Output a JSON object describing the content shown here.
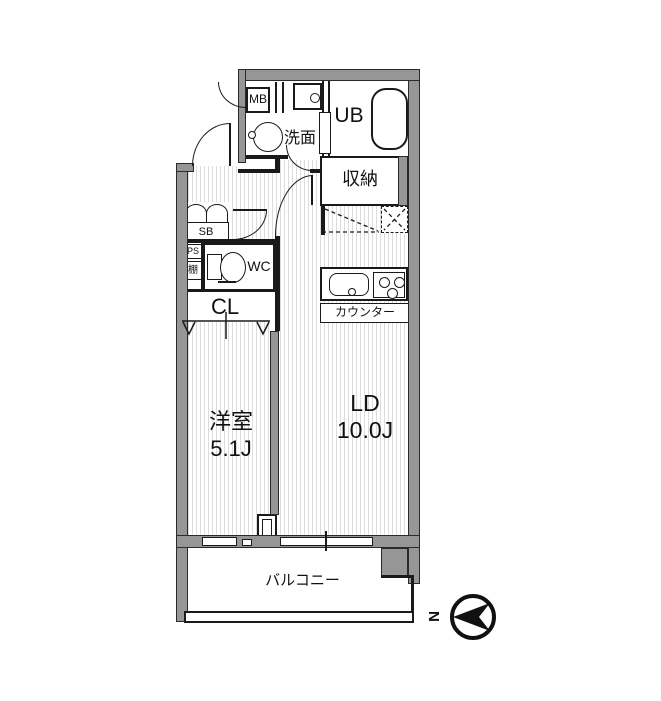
{
  "plan": {
    "rooms": {
      "mb": "MB",
      "washroom": "洗面",
      "unit_bath": "UB",
      "storage": "収納",
      "shoe_box": "SB",
      "pipe_space": "PS",
      "shelf": "棚",
      "toilet": "WC",
      "closet": "CL",
      "western_room_name": "洋室",
      "western_room_size": "5.1J",
      "living_dining_name": "LD",
      "living_dining_size": "10.0J",
      "kitchen_counter": "カウンター",
      "balcony": "バルコニー"
    },
    "compass": {
      "north": "N"
    },
    "colors": {
      "wall": "#969696",
      "line": "#1a1a1a",
      "stripe": "#dcdcdc",
      "background": "#ffffff"
    }
  }
}
